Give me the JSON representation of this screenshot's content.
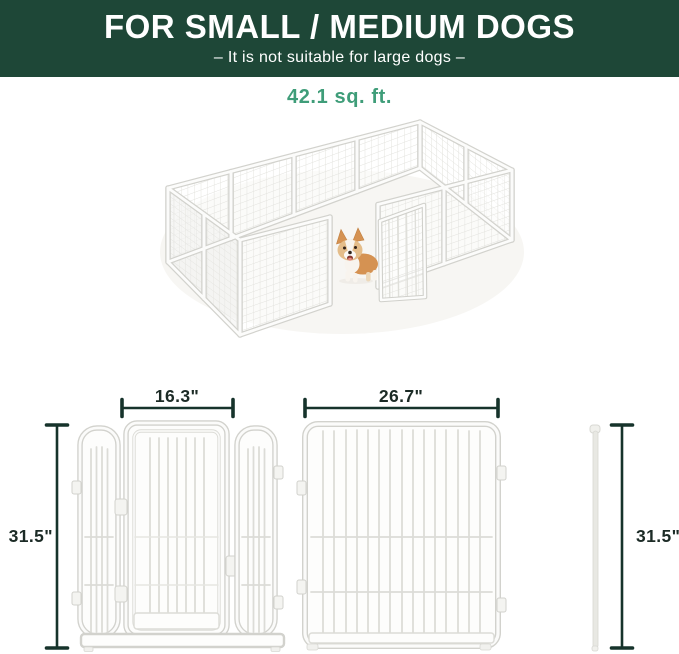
{
  "header": {
    "title": "FOR SMALL / MEDIUM DOGS",
    "subtitle": "– It is not suitable for large dogs –"
  },
  "area_label": "42.1 sq. ft.",
  "dimensions": {
    "door_section_width": "16.3\"",
    "panel_width": "26.7\"",
    "height_left": "31.5\"",
    "height_right": "31.5\""
  },
  "colors": {
    "banner_bg": "#1e4737",
    "banner_text": "#ffffff",
    "area_label_text": "#3f9d79",
    "dimension_line": "#16332b",
    "dimension_text": "#1c2b26",
    "pen_outline": "#d2d2cd",
    "pen_fill": "#ffffff",
    "dog_coat": "#d59252"
  },
  "illustration": {
    "label": "white metal dog playpen with open gate and corgi inside"
  }
}
